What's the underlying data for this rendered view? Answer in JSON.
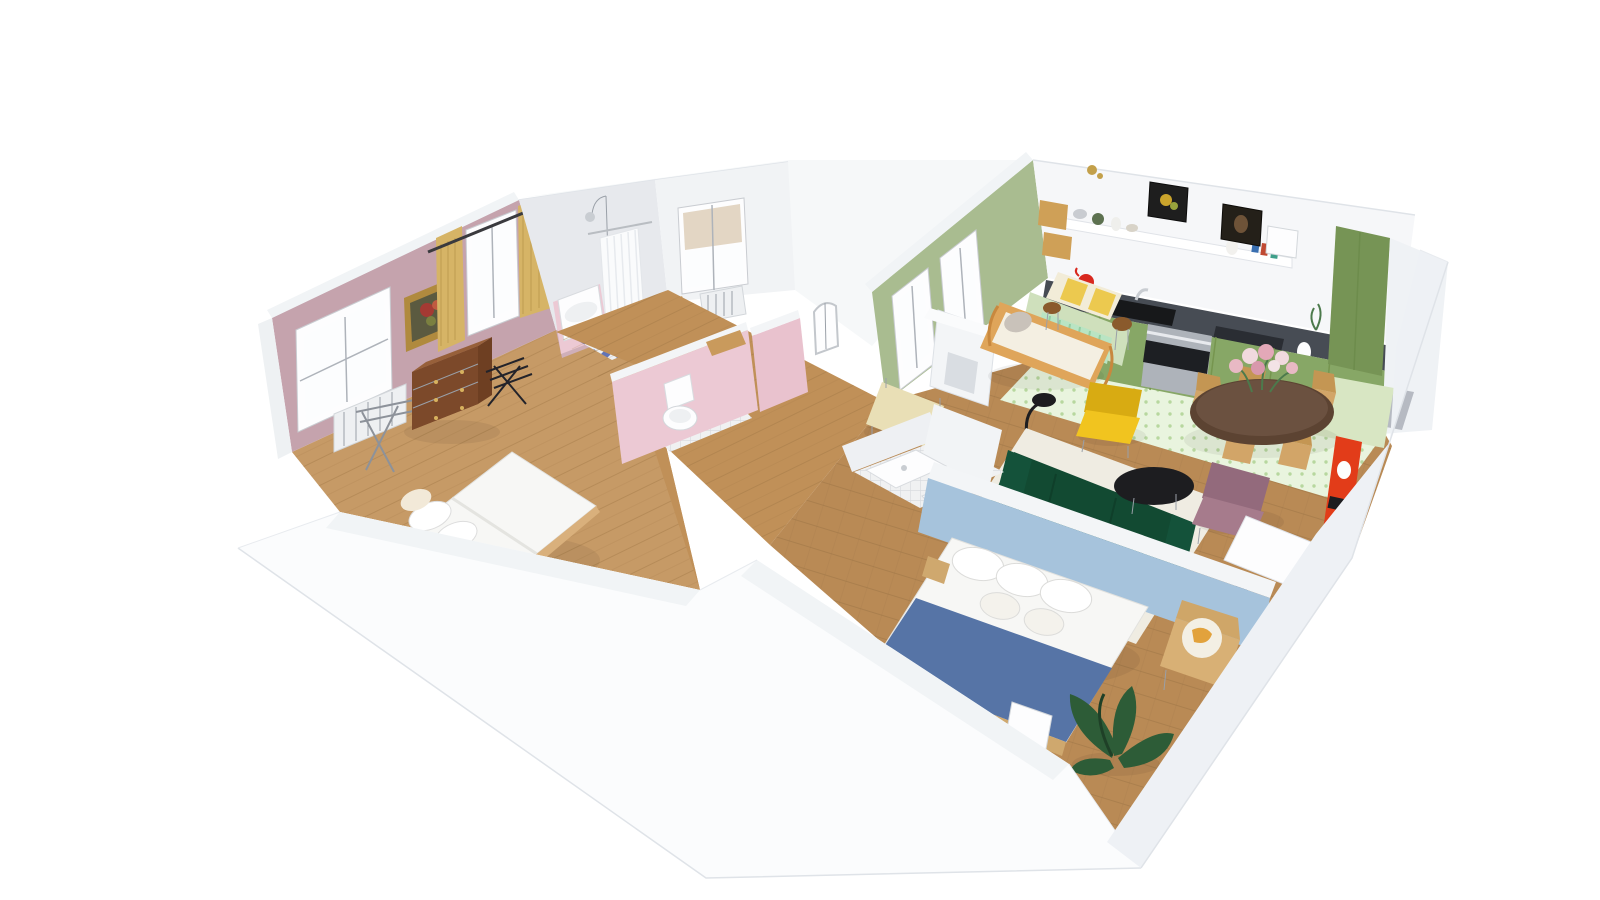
{
  "app": {
    "name": "3D floor plan - dollhouse cutaway view",
    "description": "Aerial 3D rendering of a furnished apartment on a white background",
    "background": "#ffffff"
  },
  "colors": {
    "wall_white": "#f4f6f8",
    "wall_bright": "#fbfcfd",
    "wall_top_band": "#f1f4f6",
    "wall_gray_face": "#b9bdc2",
    "outer_slab": "#f6f8f9",
    "pink_wall": "#c5a3ad",
    "pink_partition": "#ecc9d4",
    "sage_wall": "#a9bc90",
    "pistachio_wall": "#d8e6c3",
    "halfwall_green": "#cfe0bc",
    "mint_radiator": "#b9e4c3",
    "blue_wall": "#a6c3dc",
    "wood_floor": "#c69a66",
    "hall_wood": "#c09058",
    "herringbone_wood": "#b98a55",
    "gray_floor": "#b6bac2",
    "mosaic_blue": "#3d55a8",
    "kitchen_tile_base": "#e9f4de",
    "cabinet_green": "#87a766",
    "cabinet_green_dark": "#769455",
    "counter_dark": "#474c54",
    "sink_black": "#17181a",
    "curtain_yellow": "#d6b466",
    "dresser_brown": "#7c492a",
    "bed_white": "#f7f7f5",
    "blanket_blue": "#5674a6",
    "sofa_green": "#175c3e",
    "sofa_green_dark": "#124a32",
    "armchair_yellow": "#f1c41f",
    "armchair_mauve": "#a67b8c",
    "console_red": "#e23c19",
    "table_walnut": "#5c4332",
    "wood_light": "#d2a568",
    "rattan": "#dfa55a",
    "rug_cream": "#efece2",
    "bench_cream": "#e9dfb6",
    "plant_green": "#2d5c37",
    "gold_frame": "#b08a3e",
    "kettle_red": "#d8281e"
  },
  "rooms": [
    {
      "id": "bedroom-pink",
      "name": "Bedroom 1 (pink walls)",
      "wall_color": "#c5a3ad",
      "floor": "wood planks",
      "furniture": [
        "double bed with white duvet",
        "black bedside table",
        "chest of drawers",
        "luggage rack",
        "clothes drying rack",
        "radiator",
        "window",
        "window with yellow curtains",
        "framed flower painting"
      ]
    },
    {
      "id": "bathroom",
      "name": "Bathroom",
      "wall_color": "#e9ebee",
      "floor": "blue mosaic tile",
      "furniture": [
        "bathtub with pink surround",
        "shower head",
        "white shower curtain",
        "window with blind",
        "radiator",
        "wooden stool",
        "wooden side table"
      ]
    },
    {
      "id": "wc",
      "name": "WC",
      "wall_color": "#ecc9d4",
      "floor": "white tile",
      "furniture": [
        "toilet",
        "wooden bench"
      ]
    },
    {
      "id": "hallway",
      "name": "Hallway",
      "floor": "wood planks",
      "furniture": []
    },
    {
      "id": "living-room",
      "name": "Living / dining room",
      "wall_color": "#a9bc90",
      "accent_wall": "#d8e6c3",
      "floor": "herringbone wood",
      "furniture": [
        "rattan daybed with cushions",
        "mint radiator",
        "high table with yellow checked runner",
        "bar stools",
        "cream bench",
        "fireplace mantel",
        "arched floor lamp",
        "yellow armchair",
        "dark green sofa",
        "black round coffee table",
        "mauve armchair",
        "cream rug",
        "round walnut dining table",
        "flower bouquet",
        "wooden dining chairs",
        "red shelving unit",
        "white sideboard"
      ]
    },
    {
      "id": "kitchen",
      "name": "Kitchen",
      "cabinet_color": "#87a766",
      "floor": "green patterned tile",
      "furniture": [
        "green base cabinets",
        "dark countertop",
        "black sink",
        "oven",
        "tall green cabinet",
        "floating wall shelf",
        "framed pictures",
        "cork pin boards",
        "red kettle",
        "white vase"
      ]
    },
    {
      "id": "bedroom-blue",
      "name": "Bedroom 2 (blue wall)",
      "wall_color": "#a6c3dc",
      "floor": "wood planks",
      "furniture": [
        "double bed with blue blanket",
        "white pillows",
        "wooden bench",
        "leaning picture frame",
        "potted banana plant",
        "wooden chair with yellow cushion",
        "green bottle bin"
      ]
    },
    {
      "id": "shower-room",
      "name": "Shower room",
      "wall_color": "#f2f4f6",
      "floor": "white tile",
      "furniture": [
        "shower tray",
        "washbasin"
      ]
    },
    {
      "id": "entrance",
      "name": "Entrance nook",
      "floor": "gray",
      "furniture": []
    }
  ]
}
